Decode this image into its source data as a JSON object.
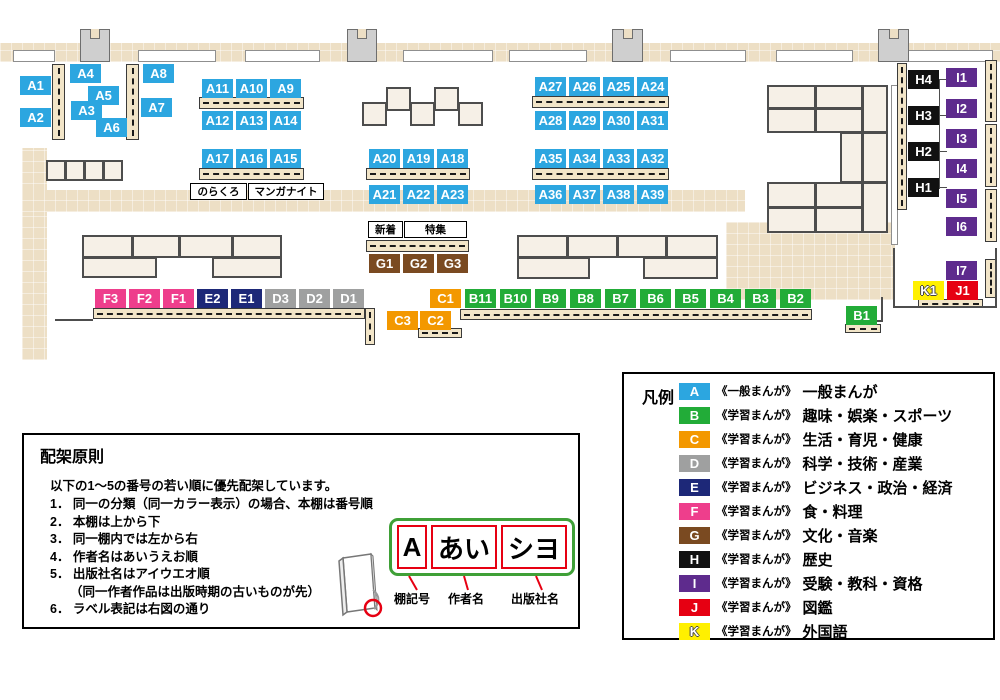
{
  "colors": {
    "A": "#2CA6E0",
    "B": "#22AC38",
    "C": "#F39800",
    "D": "#9FA0A0",
    "E": "#1D2878",
    "F": "#EE3E8C",
    "G": "#7A4A21",
    "H": "#111111",
    "I": "#5E2B8D",
    "J": "#E60012",
    "K": "#FFF000",
    "plate_green": "#3FA037",
    "pointer_red": "#E60012"
  },
  "map": {
    "labels": [
      {
        "t": "A1",
        "c": "A",
        "x": 20,
        "y": 76
      },
      {
        "t": "A2",
        "c": "A",
        "x": 20,
        "y": 108
      },
      {
        "t": "A3",
        "c": "A",
        "x": 71,
        "y": 101
      },
      {
        "t": "A4",
        "c": "A",
        "x": 70,
        "y": 64
      },
      {
        "t": "A5",
        "c": "A",
        "x": 88,
        "y": 86
      },
      {
        "t": "A6",
        "c": "A",
        "x": 96,
        "y": 118
      },
      {
        "t": "A7",
        "c": "A",
        "x": 141,
        "y": 98
      },
      {
        "t": "A8",
        "c": "A",
        "x": 143,
        "y": 64
      },
      {
        "t": "A11",
        "c": "A",
        "x": 202,
        "y": 79
      },
      {
        "t": "A10",
        "c": "A",
        "x": 236,
        "y": 79
      },
      {
        "t": "A9",
        "c": "A",
        "x": 270,
        "y": 79
      },
      {
        "t": "A12",
        "c": "A",
        "x": 202,
        "y": 111
      },
      {
        "t": "A13",
        "c": "A",
        "x": 236,
        "y": 111
      },
      {
        "t": "A14",
        "c": "A",
        "x": 270,
        "y": 111
      },
      {
        "t": "A17",
        "c": "A",
        "x": 202,
        "y": 149
      },
      {
        "t": "A16",
        "c": "A",
        "x": 236,
        "y": 149
      },
      {
        "t": "A15",
        "c": "A",
        "x": 270,
        "y": 149
      },
      {
        "t": "A20",
        "c": "A",
        "x": 369,
        "y": 149
      },
      {
        "t": "A19",
        "c": "A",
        "x": 403,
        "y": 149
      },
      {
        "t": "A18",
        "c": "A",
        "x": 437,
        "y": 149
      },
      {
        "t": "A21",
        "c": "A",
        "x": 369,
        "y": 185
      },
      {
        "t": "A22",
        "c": "A",
        "x": 403,
        "y": 185
      },
      {
        "t": "A23",
        "c": "A",
        "x": 437,
        "y": 185
      },
      {
        "t": "A27",
        "c": "A",
        "x": 535,
        "y": 77
      },
      {
        "t": "A26",
        "c": "A",
        "x": 569,
        "y": 77
      },
      {
        "t": "A25",
        "c": "A",
        "x": 603,
        "y": 77
      },
      {
        "t": "A24",
        "c": "A",
        "x": 637,
        "y": 77
      },
      {
        "t": "A28",
        "c": "A",
        "x": 535,
        "y": 111
      },
      {
        "t": "A29",
        "c": "A",
        "x": 569,
        "y": 111
      },
      {
        "t": "A30",
        "c": "A",
        "x": 603,
        "y": 111
      },
      {
        "t": "A31",
        "c": "A",
        "x": 637,
        "y": 111
      },
      {
        "t": "A35",
        "c": "A",
        "x": 535,
        "y": 149
      },
      {
        "t": "A34",
        "c": "A",
        "x": 569,
        "y": 149
      },
      {
        "t": "A33",
        "c": "A",
        "x": 603,
        "y": 149
      },
      {
        "t": "A32",
        "c": "A",
        "x": 637,
        "y": 149
      },
      {
        "t": "A36",
        "c": "A",
        "x": 535,
        "y": 185
      },
      {
        "t": "A37",
        "c": "A",
        "x": 569,
        "y": 185
      },
      {
        "t": "A38",
        "c": "A",
        "x": 603,
        "y": 185
      },
      {
        "t": "A39",
        "c": "A",
        "x": 637,
        "y": 185
      },
      {
        "t": "G1",
        "c": "G",
        "x": 369,
        "y": 254
      },
      {
        "t": "G2",
        "c": "G",
        "x": 403,
        "y": 254
      },
      {
        "t": "G3",
        "c": "G",
        "x": 437,
        "y": 254
      },
      {
        "t": "F3",
        "c": "F",
        "x": 95,
        "y": 289
      },
      {
        "t": "F2",
        "c": "F",
        "x": 129,
        "y": 289
      },
      {
        "t": "F1",
        "c": "F",
        "x": 163,
        "y": 289
      },
      {
        "t": "E2",
        "c": "E",
        "x": 197,
        "y": 289
      },
      {
        "t": "E1",
        "c": "E",
        "x": 231,
        "y": 289
      },
      {
        "t": "D3",
        "c": "D",
        "x": 265,
        "y": 289
      },
      {
        "t": "D2",
        "c": "D",
        "x": 299,
        "y": 289
      },
      {
        "t": "D1",
        "c": "D",
        "x": 333,
        "y": 289
      },
      {
        "t": "C1",
        "c": "C",
        "x": 430,
        "y": 289
      },
      {
        "t": "C3",
        "c": "C",
        "x": 387,
        "y": 311
      },
      {
        "t": "C2",
        "c": "C",
        "x": 420,
        "y": 311
      },
      {
        "t": "B11",
        "c": "B",
        "x": 465,
        "y": 289
      },
      {
        "t": "B10",
        "c": "B",
        "x": 500,
        "y": 289
      },
      {
        "t": "B9",
        "c": "B",
        "x": 535,
        "y": 289
      },
      {
        "t": "B8",
        "c": "B",
        "x": 570,
        "y": 289
      },
      {
        "t": "B7",
        "c": "B",
        "x": 605,
        "y": 289
      },
      {
        "t": "B6",
        "c": "B",
        "x": 640,
        "y": 289
      },
      {
        "t": "B5",
        "c": "B",
        "x": 675,
        "y": 289
      },
      {
        "t": "B4",
        "c": "B",
        "x": 710,
        "y": 289
      },
      {
        "t": "B3",
        "c": "B",
        "x": 745,
        "y": 289
      },
      {
        "t": "B2",
        "c": "B",
        "x": 780,
        "y": 289
      },
      {
        "t": "B1",
        "c": "B",
        "x": 846,
        "y": 306
      },
      {
        "t": "H4",
        "c": "H",
        "x": 908,
        "y": 70
      },
      {
        "t": "H3",
        "c": "H",
        "x": 908,
        "y": 106
      },
      {
        "t": "H2",
        "c": "H",
        "x": 908,
        "y": 142
      },
      {
        "t": "H1",
        "c": "H",
        "x": 908,
        "y": 178
      },
      {
        "t": "I1",
        "c": "I",
        "x": 946,
        "y": 68
      },
      {
        "t": "I2",
        "c": "I",
        "x": 946,
        "y": 99
      },
      {
        "t": "I3",
        "c": "I",
        "x": 946,
        "y": 129
      },
      {
        "t": "I4",
        "c": "I",
        "x": 946,
        "y": 159
      },
      {
        "t": "I5",
        "c": "I",
        "x": 946,
        "y": 189
      },
      {
        "t": "I6",
        "c": "I",
        "x": 946,
        "y": 217
      },
      {
        "t": "I7",
        "c": "I",
        "x": 946,
        "y": 261
      },
      {
        "t": "K1",
        "c": "K",
        "x": 913,
        "y": 281
      },
      {
        "t": "J1",
        "c": "J",
        "x": 947,
        "y": 281
      }
    ],
    "annotations": [
      {
        "t": "のらくろ",
        "x": 190,
        "y": 183,
        "w": 57,
        "h": 17
      },
      {
        "t": "マンガナイト",
        "x": 248,
        "y": 183,
        "w": 76,
        "h": 17
      },
      {
        "t": "新着",
        "x": 368,
        "y": 221,
        "w": 35,
        "h": 17
      },
      {
        "t": "特集",
        "x": 404,
        "y": 221,
        "w": 63,
        "h": 17
      }
    ]
  },
  "legend": {
    "title": "凡例",
    "items": [
      {
        "letter": "A",
        "tag": "《一般まんが》",
        "label": "一般まんが"
      },
      {
        "letter": "B",
        "tag": "《学習まんが》",
        "label": "趣味・娯楽・スポーツ"
      },
      {
        "letter": "C",
        "tag": "《学習まんが》",
        "label": "生活・育児・健康"
      },
      {
        "letter": "D",
        "tag": "《学習まんが》",
        "label": "科学・技術・産業"
      },
      {
        "letter": "E",
        "tag": "《学習まんが》",
        "label": "ビジネス・政治・経済"
      },
      {
        "letter": "F",
        "tag": "《学習まんが》",
        "label": "食・料理"
      },
      {
        "letter": "G",
        "tag": "《学習まんが》",
        "label": "文化・音楽"
      },
      {
        "letter": "H",
        "tag": "《学習まんが》",
        "label": "歴史"
      },
      {
        "letter": "I",
        "tag": "《学習まんが》",
        "label": "受験・教科・資格"
      },
      {
        "letter": "J",
        "tag": "《学習まんが》",
        "label": "図鑑"
      },
      {
        "letter": "K",
        "tag": "《学習まんが》",
        "label": "外国語"
      }
    ]
  },
  "principles": {
    "title": "配架原則",
    "intro": "以下の1～5の番号の若い順に優先配架しています。",
    "items": [
      {
        "n": "1．",
        "text": "同一の分類（同一カラー表示）の場合、本棚は番号順"
      },
      {
        "n": "2．",
        "text": "本棚は上から下"
      },
      {
        "n": "3．",
        "text": "同一棚内では左から右"
      },
      {
        "n": "4．",
        "text": "作者名はあいうえお順"
      },
      {
        "n": "5．",
        "text": "出版社名はアイウエオ順",
        "note": "（同一作者作品は出版時期の古いものが先）"
      },
      {
        "n": "6．",
        "text": "ラベル表記は右図の通り"
      }
    ]
  },
  "label_diagram": {
    "boxes": [
      "A",
      "あい",
      "シヨ"
    ],
    "captions": [
      "棚記号",
      "作者名",
      "出版社名"
    ]
  }
}
